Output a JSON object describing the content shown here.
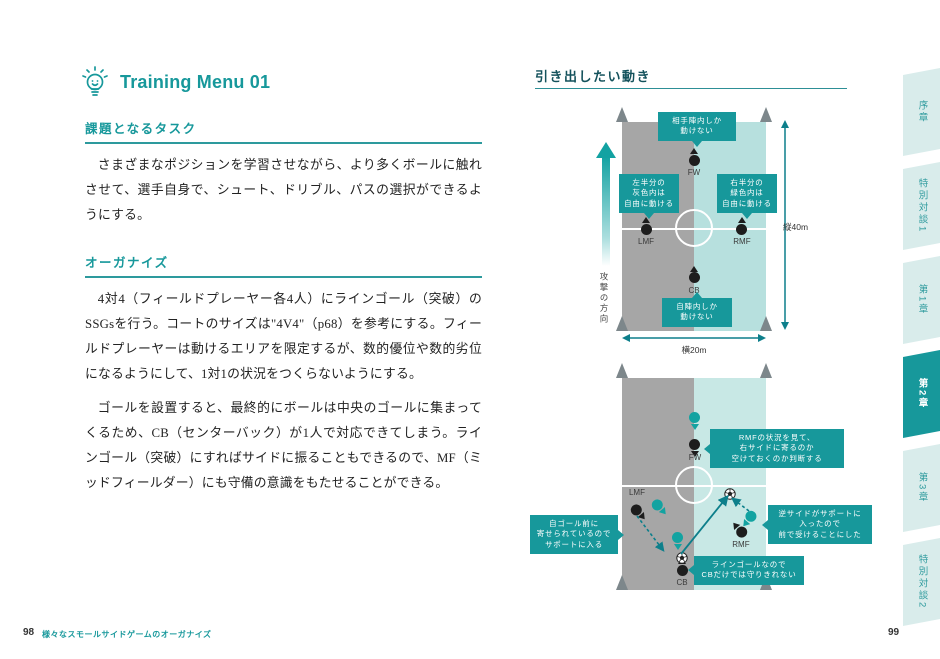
{
  "colors": {
    "accent": "#17989b",
    "heading_dark": "#14525c",
    "field_gray": "#a6a6a6",
    "field_teal_top": "#b7e0de",
    "field_teal_bottom": "#c8e8e5",
    "marker_black": "#1d1d1d",
    "marker_teal": "#13a3a1",
    "arrow_teal": "#0d7f8b",
    "flag_gray": "#7d878b",
    "tab_bg": "#d9eceb"
  },
  "left_page": {
    "header": {
      "icon": "lightbulb-icon",
      "title": "Training Menu 01"
    },
    "sections": [
      {
        "heading": "課題となるタスク",
        "paragraphs": [
          "さまざまなポジションを学習させながら、より多くボールに触れさせて、選手自身で、シュート、ドリブル、パスの選択ができるようにする。"
        ]
      },
      {
        "heading": "オーガナイズ",
        "paragraphs": [
          "4対4（フィールドプレーヤー各4人）にラインゴール（突破）のSSGsを行う。コートのサイズは\"4V4\"（p68）を参考にする。フィールドプレーヤーは動けるエリアを限定するが、数的優位や数的劣位になるようにして、1対1の状況をつくらないようにする。",
          "ゴールを設置すると、最終的にボールは中央のゴールに集まってくるため、CB（センターバック）が1人で対応できてしまう。ラインゴール（突破）にすればサイドに振ることもできるので、MF（ミッドフィールダー）にも守備の意識をもたせることができる。"
        ]
      }
    ],
    "footer": {
      "page_number": "98",
      "caption": "様々なスモールサイドゲームのオーガナイズ"
    }
  },
  "right_page": {
    "heading": "引き出したい動き",
    "footer": {
      "page_number": "99"
    },
    "diagram1": {
      "attack_direction_label": "攻撃の方向",
      "dimension_vertical": "縦40m",
      "dimension_horizontal": "横20m",
      "players": [
        {
          "label": "FW",
          "team": "black",
          "x": 50,
          "y": 18.2,
          "angle": 0,
          "label_pos": "below"
        },
        {
          "label": "LMF",
          "team": "black",
          "x": 16.7,
          "y": 51.2,
          "angle": 0,
          "label_pos": "below"
        },
        {
          "label": "RMF",
          "team": "black",
          "x": 83.3,
          "y": 51.2,
          "angle": 0,
          "label_pos": "below"
        },
        {
          "label": "CB",
          "team": "black",
          "x": 50,
          "y": 74.6,
          "angle": 0,
          "label_pos": "below"
        }
      ],
      "callouts": [
        {
          "text": "相手陣内しか\n動けない"
        },
        {
          "text": "左半分の\n灰色内は\n自由に動ける"
        },
        {
          "text": "右半分の\n緑色内は\n自由に動ける"
        },
        {
          "text": "自陣内しか\n動けない"
        }
      ]
    },
    "diagram2": {
      "players": [
        {
          "label": "",
          "team": "teal",
          "x": 50.7,
          "y": 18.9,
          "angle": 180
        },
        {
          "label": "FW",
          "team": "black",
          "x": 50.7,
          "y": 31.6,
          "angle": 180,
          "label_pos": "below"
        },
        {
          "label": "LMF",
          "team": "black",
          "x": 10.4,
          "y": 62.3,
          "angle": 140,
          "label_pos": "above"
        },
        {
          "label": "",
          "team": "teal",
          "x": 25,
          "y": 59.9,
          "angle": 140
        },
        {
          "label": "",
          "team": "teal",
          "x": 38.9,
          "y": 75.5,
          "angle": 180
        },
        {
          "label": "CB",
          "team": "black",
          "x": 41.7,
          "y": 90.6,
          "angle": 0,
          "label_pos": "below"
        },
        {
          "label": "RMF",
          "team": "black",
          "x": 82.6,
          "y": 72.6,
          "angle": -40,
          "label_pos": "below"
        },
        {
          "label": "",
          "team": "teal",
          "x": 89.6,
          "y": 65.6,
          "angle": -140
        }
      ],
      "balls": [
        {
          "x": 41.7,
          "y": 84.4
        },
        {
          "x": 75,
          "y": 54.2
        }
      ],
      "arrows": [
        {
          "x1": 15,
          "y1": 138,
          "x2": 41,
          "y2": 172,
          "style": "dashed"
        },
        {
          "x1": 59,
          "y1": 176,
          "x2": 105,
          "y2": 119,
          "style": "solid"
        },
        {
          "x1": 127,
          "y1": 133,
          "x2": 111,
          "y2": 121,
          "style": "dashed"
        }
      ],
      "callouts": [
        {
          "text": "RMFの状況を見て、\n右サイドに寄るのか\n空けておくのか判断する"
        },
        {
          "text": "自ゴール前に\n寄せられているので\nサポートに入る"
        },
        {
          "text": "逆サイドがサポートに\n入ったので\n前で受けることにした"
        },
        {
          "text": "ラインゴールなので\nCBだけでは守りきれない"
        }
      ]
    }
  },
  "sidebar": {
    "tabs": [
      {
        "label": "序章",
        "active": false
      },
      {
        "label": "特別対談1",
        "active": false
      },
      {
        "label": "第1章",
        "active": false
      },
      {
        "label": "第2章",
        "active": true
      },
      {
        "label": "第3章",
        "active": false
      },
      {
        "label": "特別対談2",
        "active": false
      }
    ]
  }
}
